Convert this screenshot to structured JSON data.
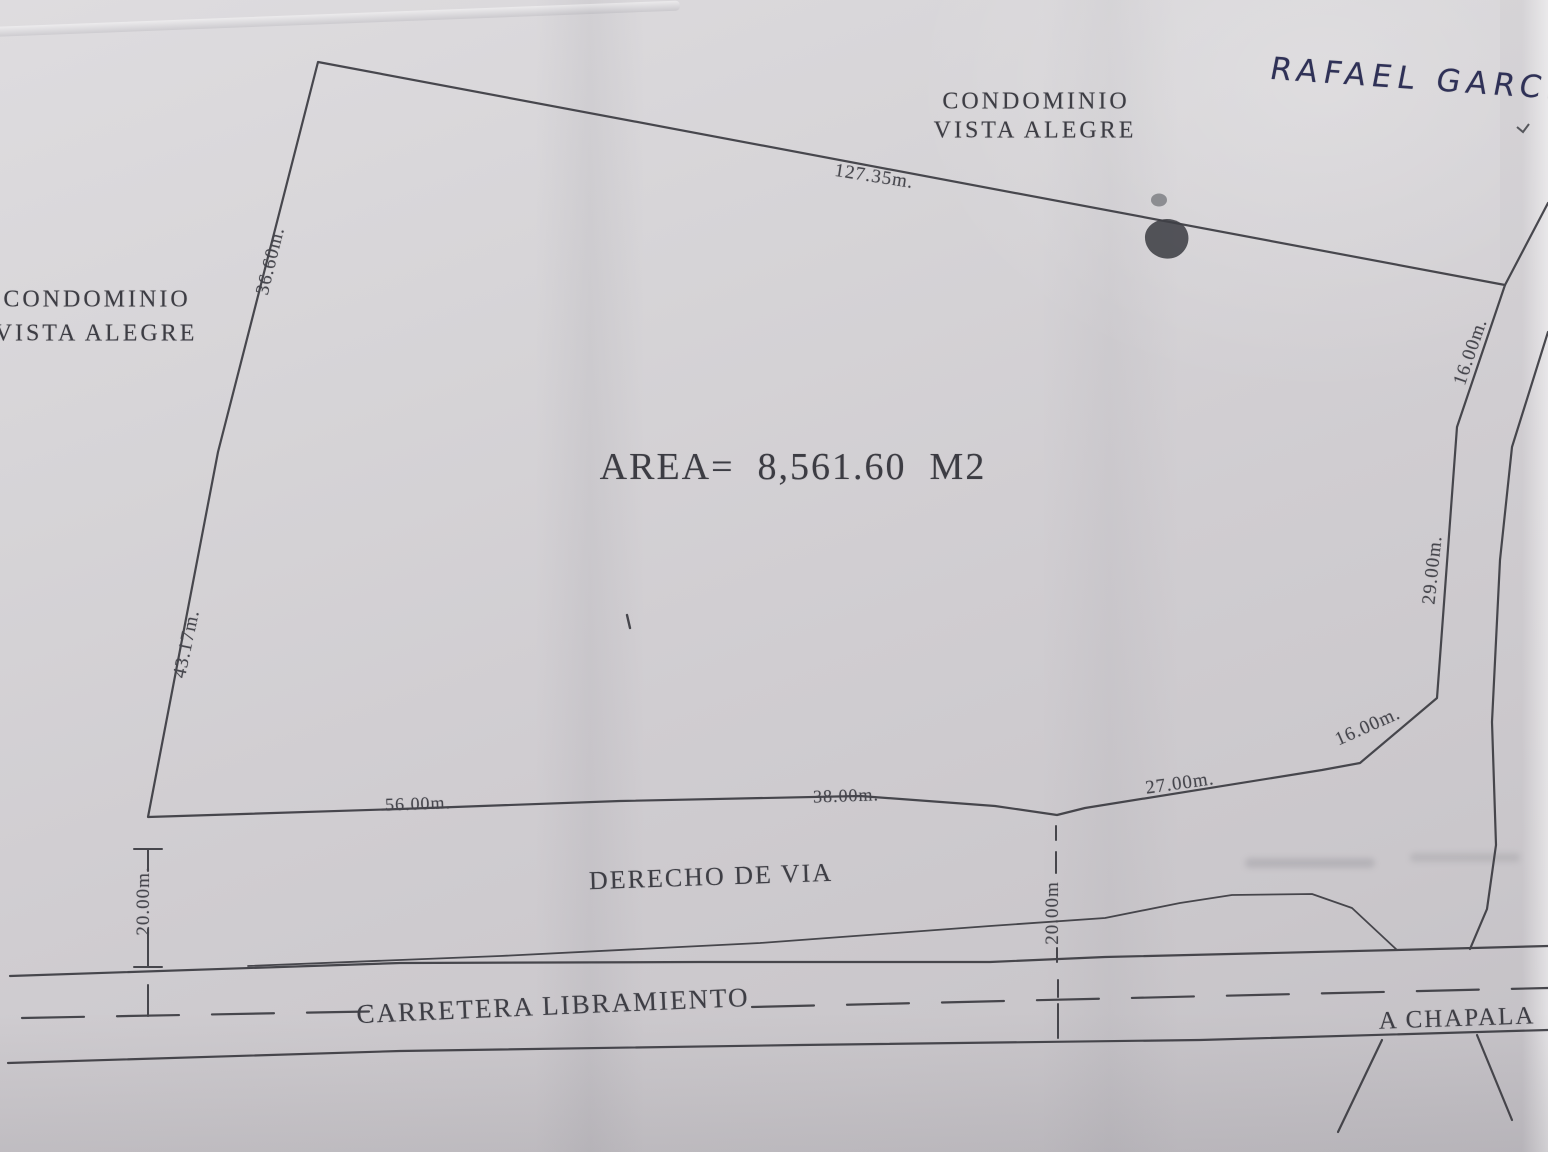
{
  "handwritten": {
    "name": "RAFAEL  GARCIA"
  },
  "labels": {
    "neighbor_top": {
      "line1": "CONDOMINIO",
      "line2": "VISTA  ALEGRE"
    },
    "neighbor_left": {
      "line1": "CONDOMINIO",
      "line2": "VISTA  ALEGRE"
    },
    "area": "AREA=  8,561.60  M2",
    "right_of_way": "DERECHO  DE  VIA",
    "road": "CARRETERA  LIBRAMIENTO",
    "direction": "A  CHAPALA"
  },
  "dimensions": {
    "top_edge": "127.35m.",
    "left_upper": "36.60m.",
    "left_lower": "43.17m.",
    "right_upper": "16.00m.",
    "right_middle": "29.00m.",
    "right_diagonal": "16.00m.",
    "bottom_right": "27.00m.",
    "bottom_middle": "38.00m.",
    "bottom_left": "56.00m.",
    "setback_left": "20.00m.",
    "setback_center": "20.00m"
  },
  "colors": {
    "ink_handwriting": "#2f3157",
    "drawing_line": "#3b3b41",
    "paper": "#d3d1d4"
  }
}
